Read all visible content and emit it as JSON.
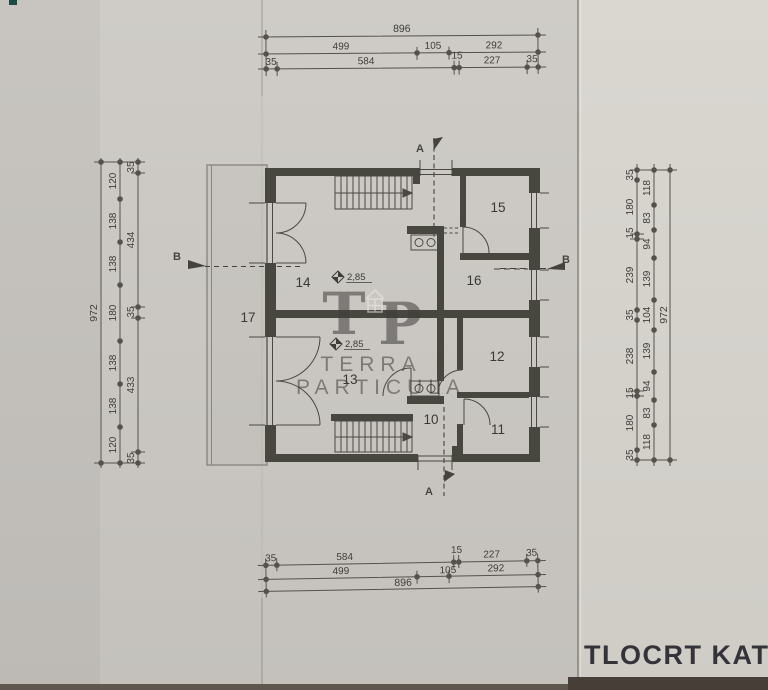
{
  "document": {
    "title": "TLOCRT KATA"
  },
  "watermark": {
    "letter_t": "T",
    "letter_p": "P",
    "line1": "TERRA",
    "line2": "PARTICULA"
  },
  "rooms": {
    "r10": "10",
    "r11": "11",
    "r12": "12",
    "r13": "13",
    "r14": "14",
    "r15": "15",
    "r16": "16",
    "r17": "17"
  },
  "levels": {
    "upper_room": "2,85",
    "lower_room": "2,85"
  },
  "sections": {
    "a": "A",
    "b": "B"
  },
  "dims": {
    "top": {
      "total": "896",
      "mid": [
        "499",
        "105",
        "292"
      ],
      "inner": [
        "35",
        "584",
        "15",
        "227",
        "35"
      ]
    },
    "bottom": {
      "total": "896",
      "mid": [
        "499",
        "105",
        "292"
      ],
      "inner": [
        "35",
        "584",
        "15",
        "227",
        "35"
      ]
    },
    "left": {
      "total": "972",
      "mid": [
        "120",
        "138",
        "138",
        "180",
        "138",
        "138",
        "120"
      ],
      "inner": [
        "35",
        "434",
        "35",
        "433",
        "35"
      ]
    },
    "right": {
      "total": "972",
      "mid": [
        "118",
        "83",
        "94",
        "139",
        "104",
        "139",
        "94",
        "83",
        "118"
      ],
      "inner": [
        "35",
        "180",
        "15",
        "239",
        "35",
        "238",
        "15",
        "180",
        "35"
      ]
    }
  },
  "colors": {
    "paper": "#cbc8c3",
    "paper_right": "#d6d3cd",
    "ink": "#3f3d3a",
    "wall": "#47463f",
    "corner_mark": "#1d4a44"
  }
}
